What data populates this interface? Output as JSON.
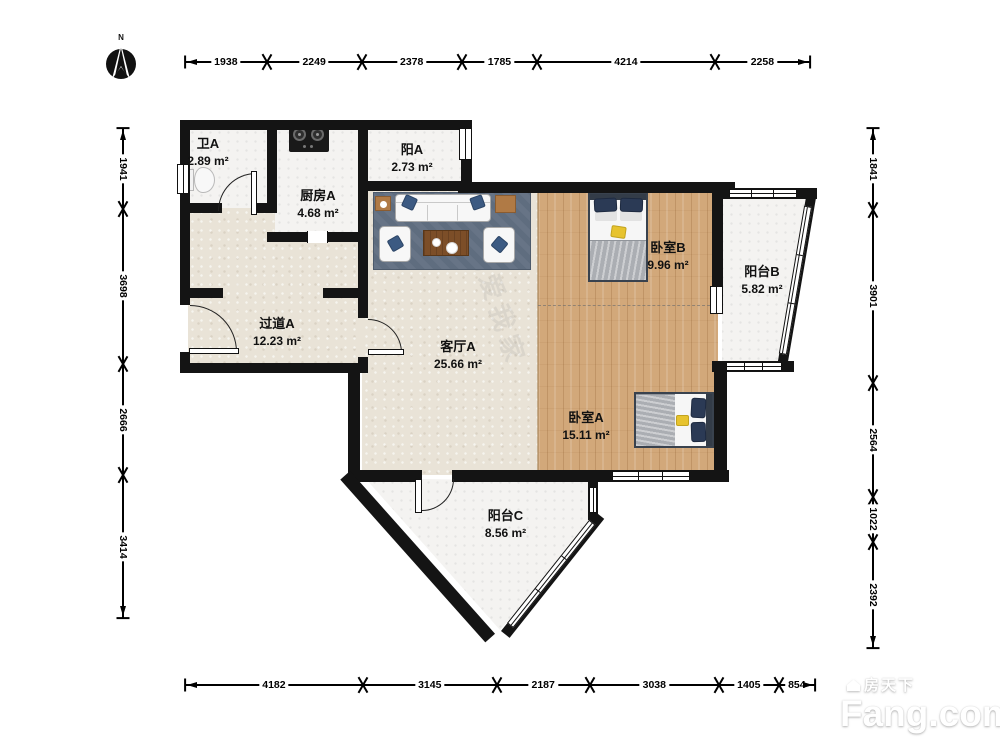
{
  "compass": {
    "label": "N"
  },
  "rooms": [
    {
      "name": "卫A",
      "area": "2.89 m²"
    },
    {
      "name": "厨房A",
      "area": "4.68 m²"
    },
    {
      "name": "阳A",
      "area": "2.73 m²"
    },
    {
      "name": "过道A",
      "area": "12.23 m²"
    },
    {
      "name": "客厅A",
      "area": "25.66 m²"
    },
    {
      "name": "卧室B",
      "area": "9.96 m²"
    },
    {
      "name": "阳台B",
      "area": "5.82 m²"
    },
    {
      "name": "卧室A",
      "area": "15.11 m²"
    },
    {
      "name": "阳台C",
      "area": "8.56 m²"
    }
  ],
  "dimensions": {
    "top": [
      1938,
      2249,
      2378,
      1785,
      4214,
      2258
    ],
    "left": [
      1941,
      3698,
      2666,
      3414
    ],
    "right": [
      1841,
      3901,
      2564,
      1022,
      2392
    ],
    "bottom": [
      4182,
      3145,
      2187,
      3038,
      1405,
      854
    ]
  },
  "logo": {
    "site_cn": "房天下",
    "site_en": "Fang.com"
  },
  "watermark": {
    "agency": "我爱我家"
  },
  "colors": {
    "wall": "#141414",
    "wood_floor": "#d2a87a",
    "carpet": "#e9e3d7",
    "tile": "#f4f3f1",
    "rug": "#5f6d7f",
    "pillow_navy": "#2b3a55"
  }
}
